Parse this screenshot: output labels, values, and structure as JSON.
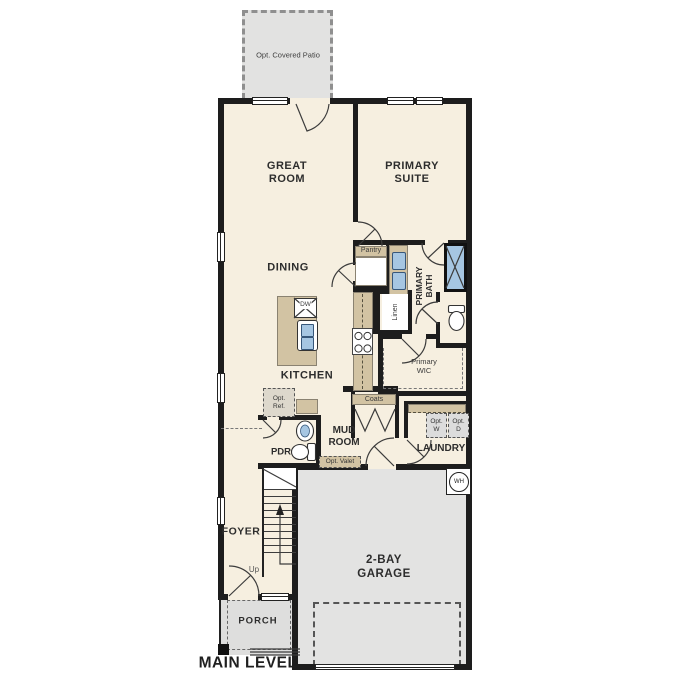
{
  "plan": {
    "level": "MAIN LEVEL"
  },
  "outdoor": {
    "patio": "Opt. Covered Patio",
    "porch": "PORCH",
    "garage": "2-BAY\nGARAGE"
  },
  "rooms": {
    "great_room": "GREAT\nROOM",
    "primary_suite": "PRIMARY\nSUITE",
    "dining": "DINING",
    "kitchen": "KITCHEN",
    "primary_bath": "PRIMARY\nBATH",
    "primary_wic": "Primary\nWIC",
    "mud_room": "MUD\nROOM",
    "laundry": "LAUNDRY",
    "pdr": "PDR",
    "foyer": "FOYER"
  },
  "closets": {
    "pantry": "Pantry",
    "linen": "Linen",
    "coats": "Coats"
  },
  "appliances": {
    "dishwasher": "DW",
    "washer": "Opt.\nW",
    "dryer": "Opt.\nD",
    "refrigerator": "Opt.\nRef.",
    "water_heater": "WH"
  },
  "features": {
    "valet": "Opt. Valet"
  },
  "stairs": {
    "direction": "Up"
  },
  "colors": {
    "floor": "#f6efe0",
    "outdoor": "#e3e3e2",
    "wall": "#1d1d1d",
    "cabinet": "#d2c3a3",
    "fixture_blue": "#a6c6e2"
  }
}
